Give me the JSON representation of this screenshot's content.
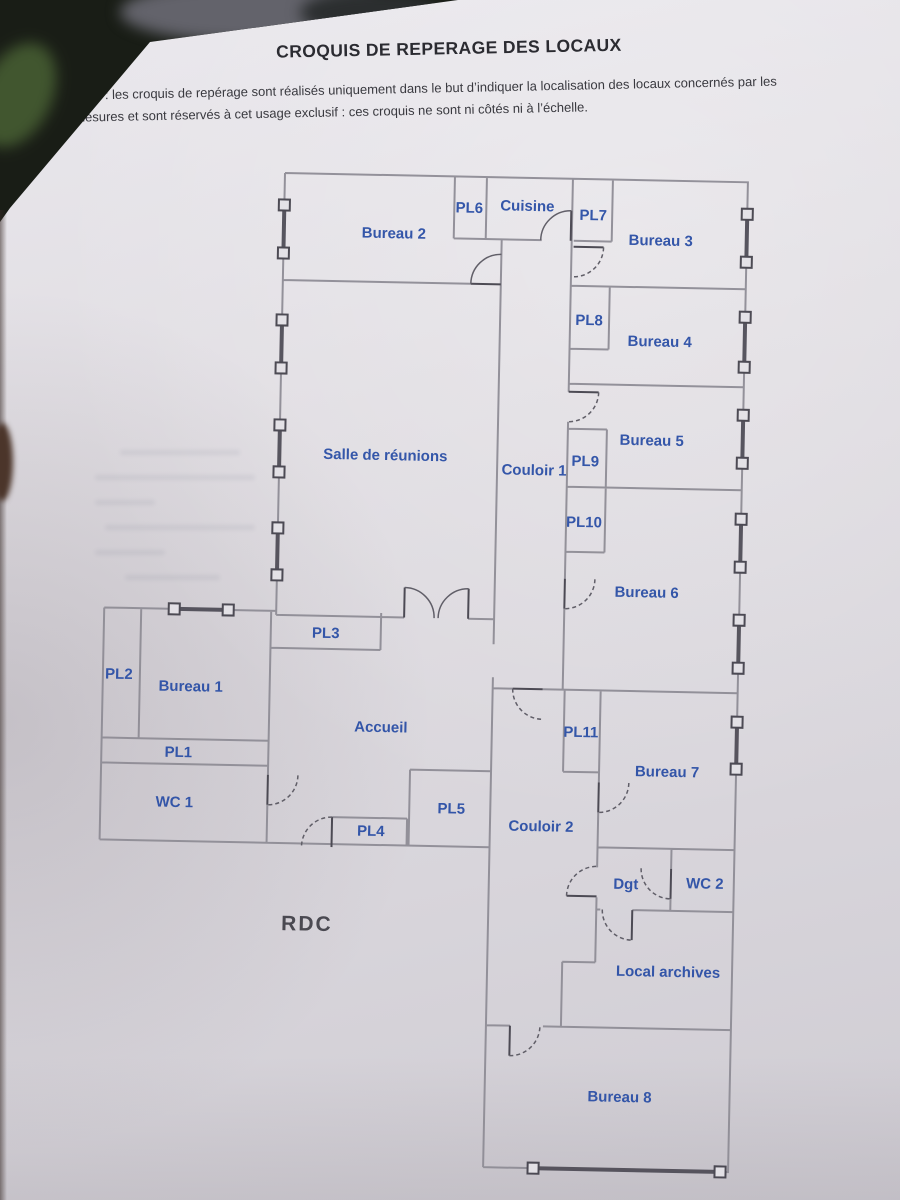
{
  "header": {
    "title": "CROQUIS DE REPERAGE DES LOCAUX",
    "nota_label": "Nota",
    "nota_line1": " : les croquis de repérage sont réalisés uniquement dans le but d’indiquer la localisation des locaux concernés par les",
    "nota_line2": "mesures et sont réservés à cet usage exclusif : ces croquis ne sont ni côtés ni à l’échelle."
  },
  "floor_label": "RDC",
  "colors": {
    "label_blue": "#2b4fa6",
    "wall_gray": "#8f8d96",
    "window_dark": "#504e58",
    "paper": "#dcd9df",
    "photo_background": "#191d16"
  },
  "rooms": [
    {
      "label": "Bureau 2"
    },
    {
      "label": "PL6"
    },
    {
      "label": "Cuisine"
    },
    {
      "label": "PL7"
    },
    {
      "label": "Bureau 3"
    },
    {
      "label": "PL8"
    },
    {
      "label": "Bureau 4"
    },
    {
      "label": "Bureau 5"
    },
    {
      "label": "PL9"
    },
    {
      "label": "PL10"
    },
    {
      "label": "Bureau 6"
    },
    {
      "label": "Salle de réunions"
    },
    {
      "label": "Couloir 1"
    },
    {
      "label": "PL3"
    },
    {
      "label": "PL2"
    },
    {
      "label": "Bureau 1"
    },
    {
      "label": "PL1"
    },
    {
      "label": "WC 1"
    },
    {
      "label": "Accueil"
    },
    {
      "label": "PL5"
    },
    {
      "label": "PL4"
    },
    {
      "label": "Couloir 2"
    },
    {
      "label": "PL11"
    },
    {
      "label": "Bureau 7"
    },
    {
      "label": "Dgt"
    },
    {
      "label": "WC 2"
    },
    {
      "label": "Local archives"
    },
    {
      "label": "Bureau 8"
    }
  ]
}
